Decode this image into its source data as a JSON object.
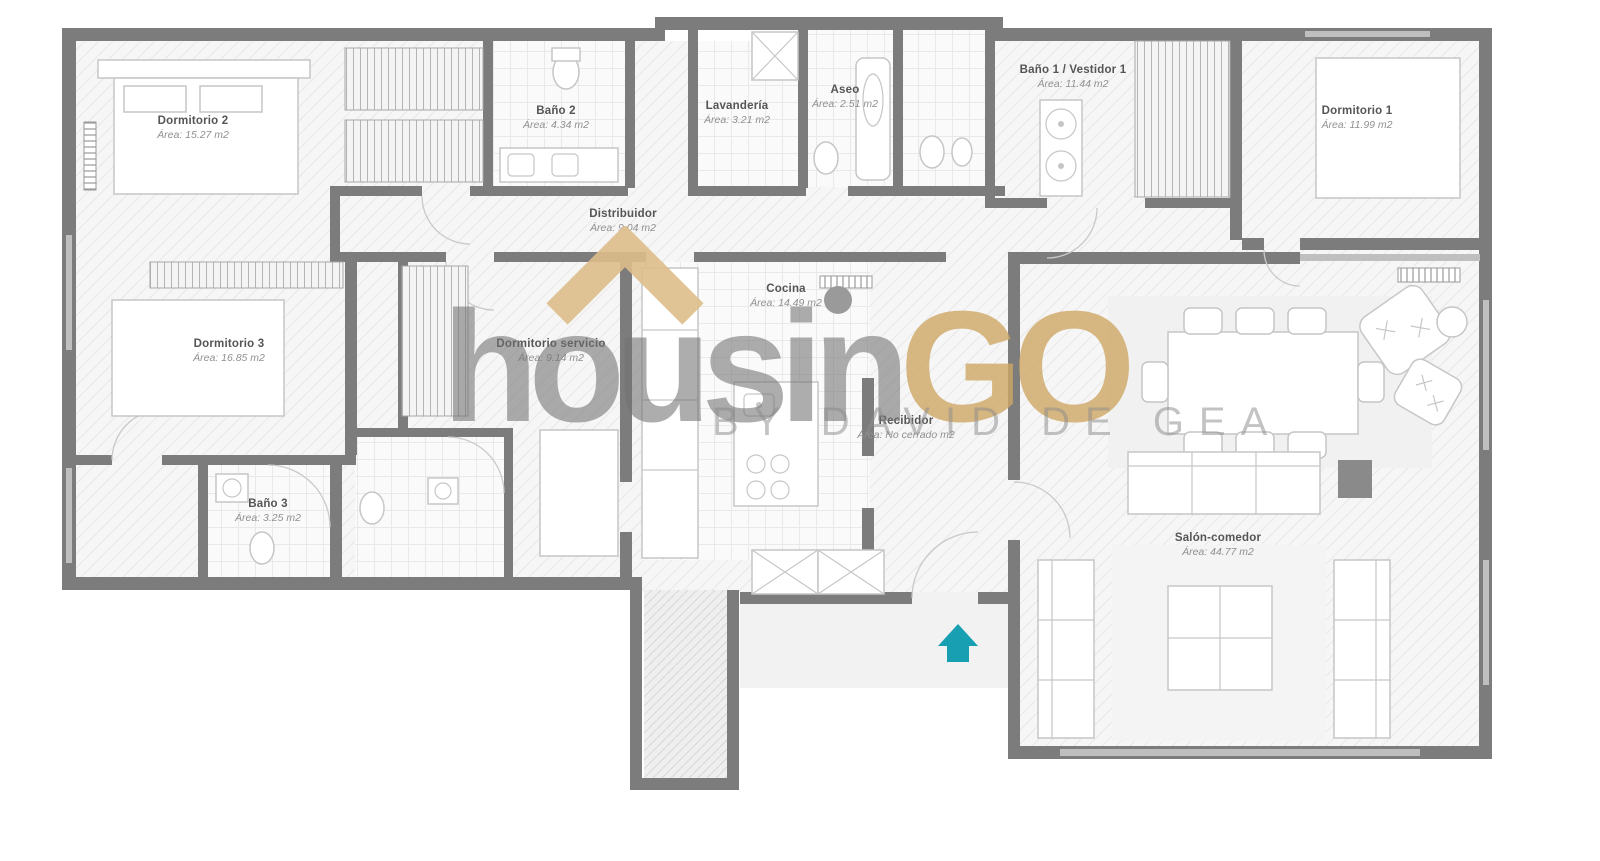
{
  "plan": {
    "rooms": [
      {
        "name": "Dormitorio 2",
        "area": "Área: 15.27 m2"
      },
      {
        "name": "Baño 2",
        "area": "Área: 4.34 m2"
      },
      {
        "name": "Lavandería",
        "area": "Área: 3.21 m2"
      },
      {
        "name": "Aseo",
        "area": "Área: 2.51 m2"
      },
      {
        "name": "Baño 1 / Vestidor 1",
        "area": "Área: 11.44 m2"
      },
      {
        "name": "Dormitorio 1",
        "area": "Área: 11.99 m2"
      },
      {
        "name": "Distribuidor",
        "area": "Área: 9.04 m2"
      },
      {
        "name": "Cocina",
        "area": "Área: 14.49 m2"
      },
      {
        "name": "Dormitorio 3",
        "area": "Área: 16.85 m2"
      },
      {
        "name": "Dormitorio servicio",
        "area": "Área: 9.14 m2"
      },
      {
        "name": "Recibidor",
        "area": "Área: No cerrado m2"
      },
      {
        "name": "Baño 3",
        "area": "Área: 3.25 m2"
      },
      {
        "name": "Salón-comedor",
        "area": "Área: 44.77 m2"
      }
    ]
  },
  "watermark": {
    "brand_gray": "housin",
    "brand_gold": "GO",
    "tagline": "BY DAVID DE GEA",
    "gold_color": "#cea664",
    "gray_color": "#717171"
  },
  "entrance": {
    "marker_color": "#18a0b2"
  }
}
